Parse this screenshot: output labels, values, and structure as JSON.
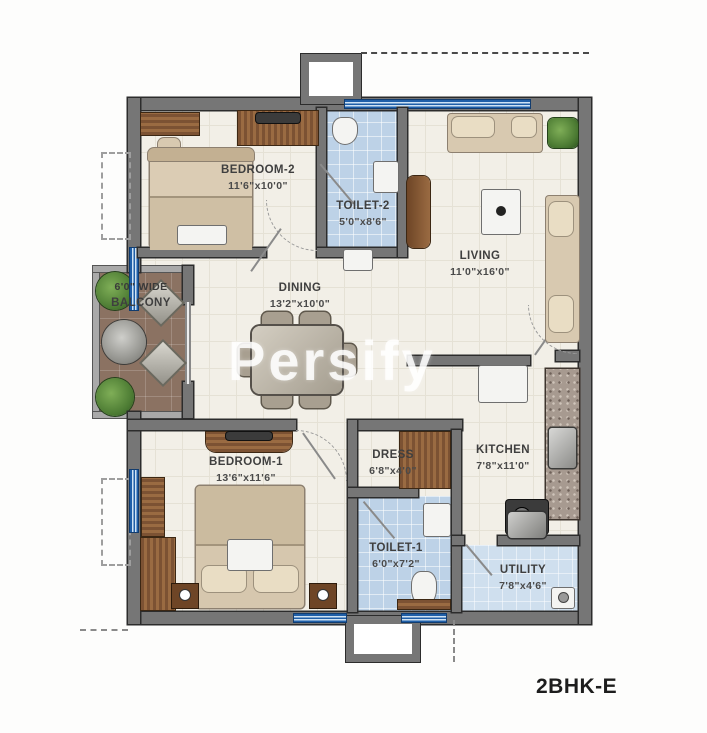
{
  "plan": {
    "title": "2BHK-E",
    "watermark": "Persify"
  },
  "rooms": {
    "bedroom2": {
      "name": "BEDROOM-2",
      "dims": "11'6\"x10'0\""
    },
    "toilet2": {
      "name": "TOILET-2",
      "dims": "5'0\"x8'6\""
    },
    "living": {
      "name": "LIVING",
      "dims": "11'0\"x16'0\""
    },
    "dining": {
      "name": "DINING",
      "dims": "13'2\"x10'0\""
    },
    "balcony": {
      "name": "BALCONY",
      "dims": "6'0\" WIDE"
    },
    "bedroom1": {
      "name": "BEDROOM-1",
      "dims": "13'6\"x11'6\""
    },
    "dress": {
      "name": "DRESS",
      "dims": "6'8\"x4'0\""
    },
    "toilet1": {
      "name": "TOILET-1",
      "dims": "6'0\"x7'2\""
    },
    "kitchen": {
      "name": "KITCHEN",
      "dims": "7'8\"x11'0\""
    },
    "utility": {
      "name": "UTILITY",
      "dims": "7'8\"x4'6\""
    }
  },
  "colors": {
    "wall": "#767676",
    "window_blue": "#1f5fa8",
    "toilet_floor": "#bdd2e7",
    "utility_floor": "#cfdfee",
    "balcony_floor": "#8b7262",
    "wood": "#9a6b42",
    "label_text": "#3f3f3f"
  }
}
